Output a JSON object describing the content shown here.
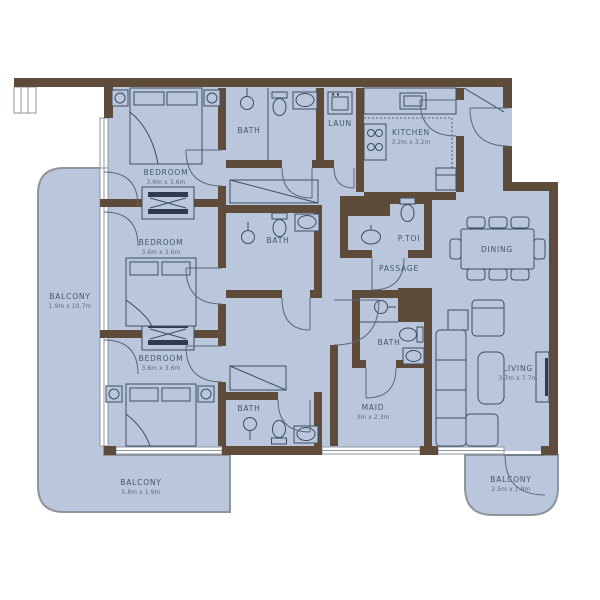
{
  "plan_title": "Apartment Floor Plan",
  "colors": {
    "wall": "#5f4b39",
    "floor": "#b9c6db",
    "furniture_line": "#3d4d63",
    "label_text": "#45566c",
    "balcony_border": "#8f959d",
    "background": "#ffffff"
  },
  "rooms": {
    "bedroom1": {
      "label": "BEDROOM",
      "dims": "3.6m x 3.6m"
    },
    "bedroom2": {
      "label": "BEDROOM",
      "dims": "3.6m x 3.6m"
    },
    "bedroom3": {
      "label": "BEDROOM",
      "dims": "3.6m x 3.6m"
    },
    "bath1": {
      "label": "BATH"
    },
    "bath2": {
      "label": "BATH"
    },
    "bath3": {
      "label": "BATH"
    },
    "maid_bath": {
      "label": "BATH"
    },
    "laundry": {
      "label": "LAUN"
    },
    "kitchen": {
      "label": "KITCHEN",
      "dims": "3.2m x 3.2m"
    },
    "powder_toilet": {
      "label": "P.TOI"
    },
    "passage": {
      "label": "PASSAGE"
    },
    "dining": {
      "label": "DINING"
    },
    "living": {
      "label": "LIVING",
      "dims": "3.7m x 7.7m"
    },
    "maid": {
      "label": "MAID",
      "dims": "3m x 2.3m"
    },
    "balcony_left": {
      "label": "BALCONY",
      "dims": "1.9m x 10.7m"
    },
    "balcony_bottom": {
      "label": "BALCONY",
      "dims": "5.8m x 1.9m"
    },
    "balcony_right": {
      "label": "BALCONY",
      "dims": "2.5m x 1.9m"
    }
  }
}
